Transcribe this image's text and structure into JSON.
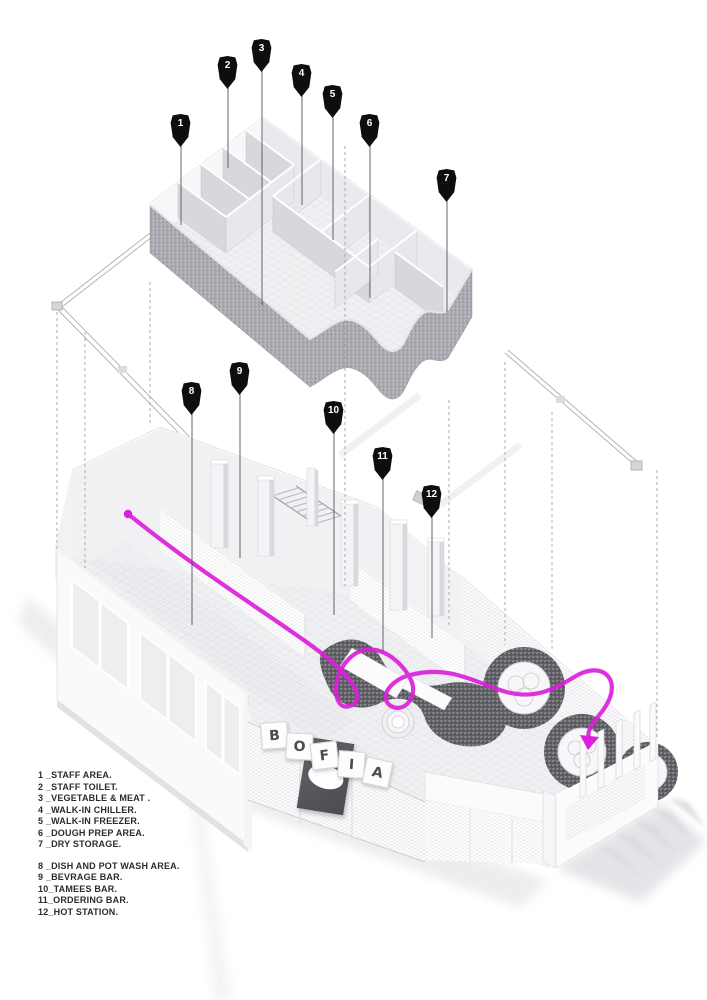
{
  "colors": {
    "background": "#ffffff",
    "circulation_path": "#DB1FDB",
    "pin": "#0E0E10",
    "pin_number": "#FFFFFF",
    "speckle_light_wall": "#A7A7AD",
    "speckle_dark_counter": "#606066",
    "legend_text": "#2B2B2B"
  },
  "drawing": {
    "type": "exploded-axonometric-restaurant-plan",
    "upper_level_markers": "1-7",
    "lower_level_markers": "8-12"
  },
  "sign": {
    "letters": [
      "B",
      "O",
      "F",
      "I",
      "A"
    ]
  },
  "markers": [
    {
      "num": "1"
    },
    {
      "num": "2"
    },
    {
      "num": "3"
    },
    {
      "num": "4"
    },
    {
      "num": "5"
    },
    {
      "num": "6"
    },
    {
      "num": "7"
    },
    {
      "num": "8"
    },
    {
      "num": "9"
    },
    {
      "num": "10"
    },
    {
      "num": "11"
    },
    {
      "num": "12"
    }
  ],
  "legend": {
    "groups": [
      {
        "items": [
          "1 _STAFF AREA.",
          "2 _STAFF TOILET.",
          "3 _VEGETABLE & MEAT .",
          "4 _WALK-IN CHILLER.",
          "5 _WALK-IN FREEZER.",
          "6 _DOUGH PREP AREA.",
          "7 _DRY STORAGE."
        ]
      },
      {
        "items": [
          "8 _DISH AND POT WASH AREA.",
          "9 _BEVRAGE BAR.",
          "10_TAMEES BAR.",
          "11_ORDERING BAR.",
          "12_HOT STATION."
        ]
      }
    ]
  }
}
